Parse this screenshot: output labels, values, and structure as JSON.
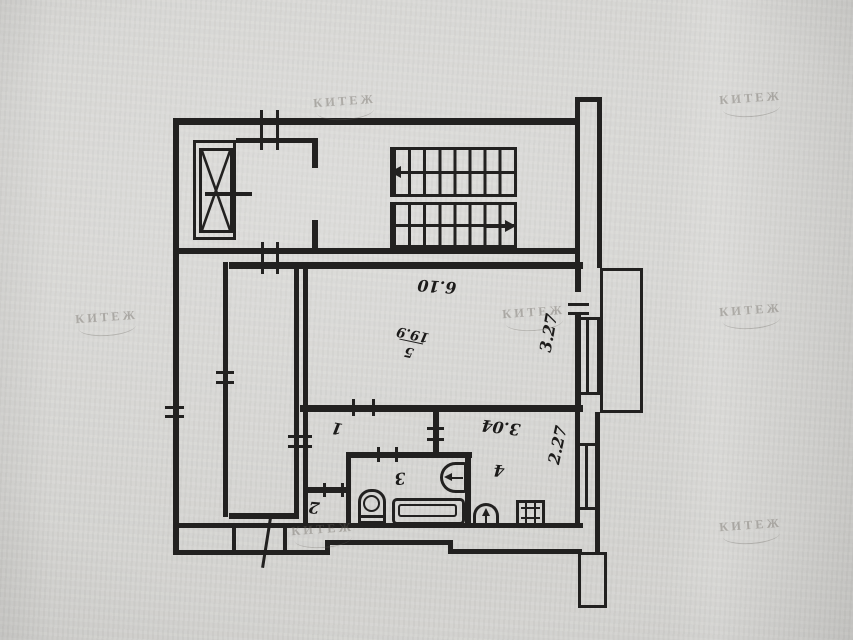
{
  "document": {
    "kind": "apartment floor plan (photographed paper drawing, rotated 180°)",
    "watermark": {
      "text": "КИТЕЖ"
    }
  },
  "rooms": [
    {
      "label": "1",
      "name": "hallway"
    },
    {
      "label": "2",
      "name": "closet"
    },
    {
      "label": "3",
      "name": "bathroom"
    },
    {
      "label": "4",
      "name": "kitchen"
    },
    {
      "label": "5",
      "name": "living-room",
      "area": "19.9"
    }
  ],
  "dimensions": {
    "room5_width": "6.10",
    "room5_depth": "3.27",
    "kitchen_width": "3.04",
    "kitchen_depth": "2.27"
  },
  "colors": {
    "ink": "#222120",
    "paper": "#d5d4d1",
    "watermark": "#68645d"
  }
}
